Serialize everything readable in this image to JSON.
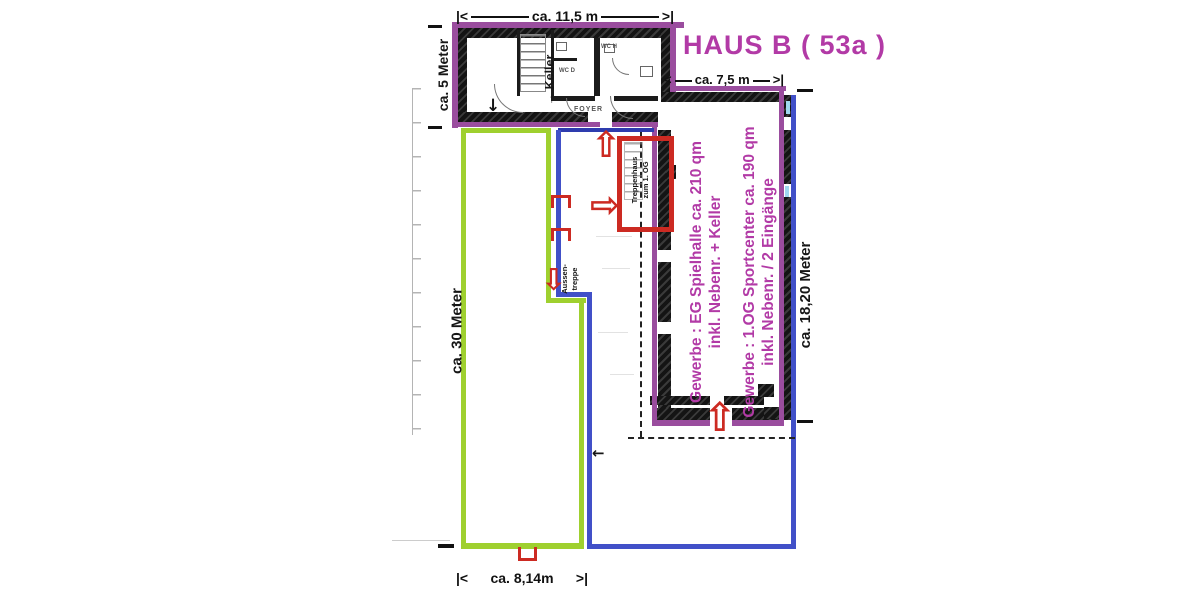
{
  "title": "HAUS B ( 53a )",
  "dimensions": {
    "top": {
      "marker_left": "|<",
      "label": "ca. 11,5 m",
      "marker_right": ">|"
    },
    "wing": {
      "marker_left": "<",
      "label": "ca. 7,5 m",
      "marker_right": ">|"
    },
    "upper_left": {
      "label": "ca. 5 Meter"
    },
    "left": {
      "label": "ca. 30 Meter"
    },
    "right": {
      "label": "ca. 18,20 Meter"
    },
    "bottom": {
      "marker_left": "|<",
      "label": "ca. 8,14m",
      "marker_right": ">|"
    }
  },
  "annotations": {
    "gewerbe_eg": {
      "line1": "Gewerbe : EG Spielhalle ca. 210 qm",
      "line2": "inkl. Nebenr. + Keller"
    },
    "gewerbe_og": {
      "line1": "Gewerbe : 1.OG Sportcenter ca. 190 qm",
      "line2": "inkl. Nebenr. / 2 Eingänge"
    },
    "treppenhaus": {
      "line1": "Treppenhaus",
      "line2": "zum 1. OG"
    },
    "aussentreppe": {
      "line1": "Aussen-",
      "line2": "treppe"
    },
    "keller": "Keller",
    "foyer": "FOYER",
    "wc_damen": "WC D",
    "wc_herren": "WC H"
  },
  "glyphs": {
    "arrow_up_hollow": "⇧",
    "arrow_right_hollow": "⇨",
    "arrow_down_hollow": "⇩",
    "arrow_up": "→",
    "arrow_down": "↓",
    "arrow_left": "←"
  },
  "colors": {
    "magenta_text": "#b23aa6",
    "purple_outline": "#9a4d9e",
    "green_outline": "#9fd02f",
    "blue_outline": "#4150c8",
    "red_marker": "#cc2a22",
    "cyan_accent": "#9fd8ef",
    "wall_black": "#1b1b1b"
  }
}
